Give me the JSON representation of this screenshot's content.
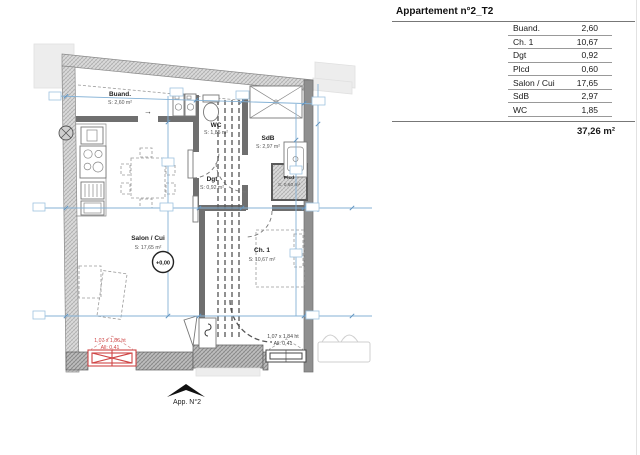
{
  "legend": {
    "title": "Appartement n°2_T2",
    "rows": [
      {
        "label": "Buand.",
        "value": "2,60"
      },
      {
        "label": "Ch. 1",
        "value": "10,67"
      },
      {
        "label": "Dgt",
        "value": "0,92"
      },
      {
        "label": "Plcd",
        "value": "0,60"
      },
      {
        "label": "Salon / Cui",
        "value": "17,65"
      },
      {
        "label": "SdB",
        "value": "2,97"
      },
      {
        "label": "WC",
        "value": "1,85"
      }
    ],
    "total": "37,26 m²"
  },
  "plan": {
    "rooms": [
      {
        "name": "Buand.",
        "area": "S: 2,60 m²"
      },
      {
        "name": "WC",
        "area": "S: 1,85 m²"
      },
      {
        "name": "SdB",
        "area": "S: 2,97 m²"
      },
      {
        "name": "Dgt",
        "area": "S: 0,92 m²"
      },
      {
        "name": "Plcd",
        "area": "S: 0,60 m²"
      },
      {
        "name": "Salon / Cui",
        "area": "S: 17,65 m²"
      },
      {
        "name": "Ch. 1",
        "area": "S: 10,67 m²"
      }
    ],
    "level_marker": "+0,00",
    "windows": {
      "living": {
        "dims": "1,07 x 1,86 ht",
        "sill": "All: 0,41"
      },
      "bedroom": {
        "dims": "1,07 x 1,84 ht",
        "sill": "All: 0,41"
      }
    },
    "entrance_label": "App. N°2",
    "door_arrow": "→",
    "colors": {
      "dimension_blue": "#85b2d6",
      "window_red": "#cf4545",
      "wall_gray": "#c4c4c4"
    }
  }
}
